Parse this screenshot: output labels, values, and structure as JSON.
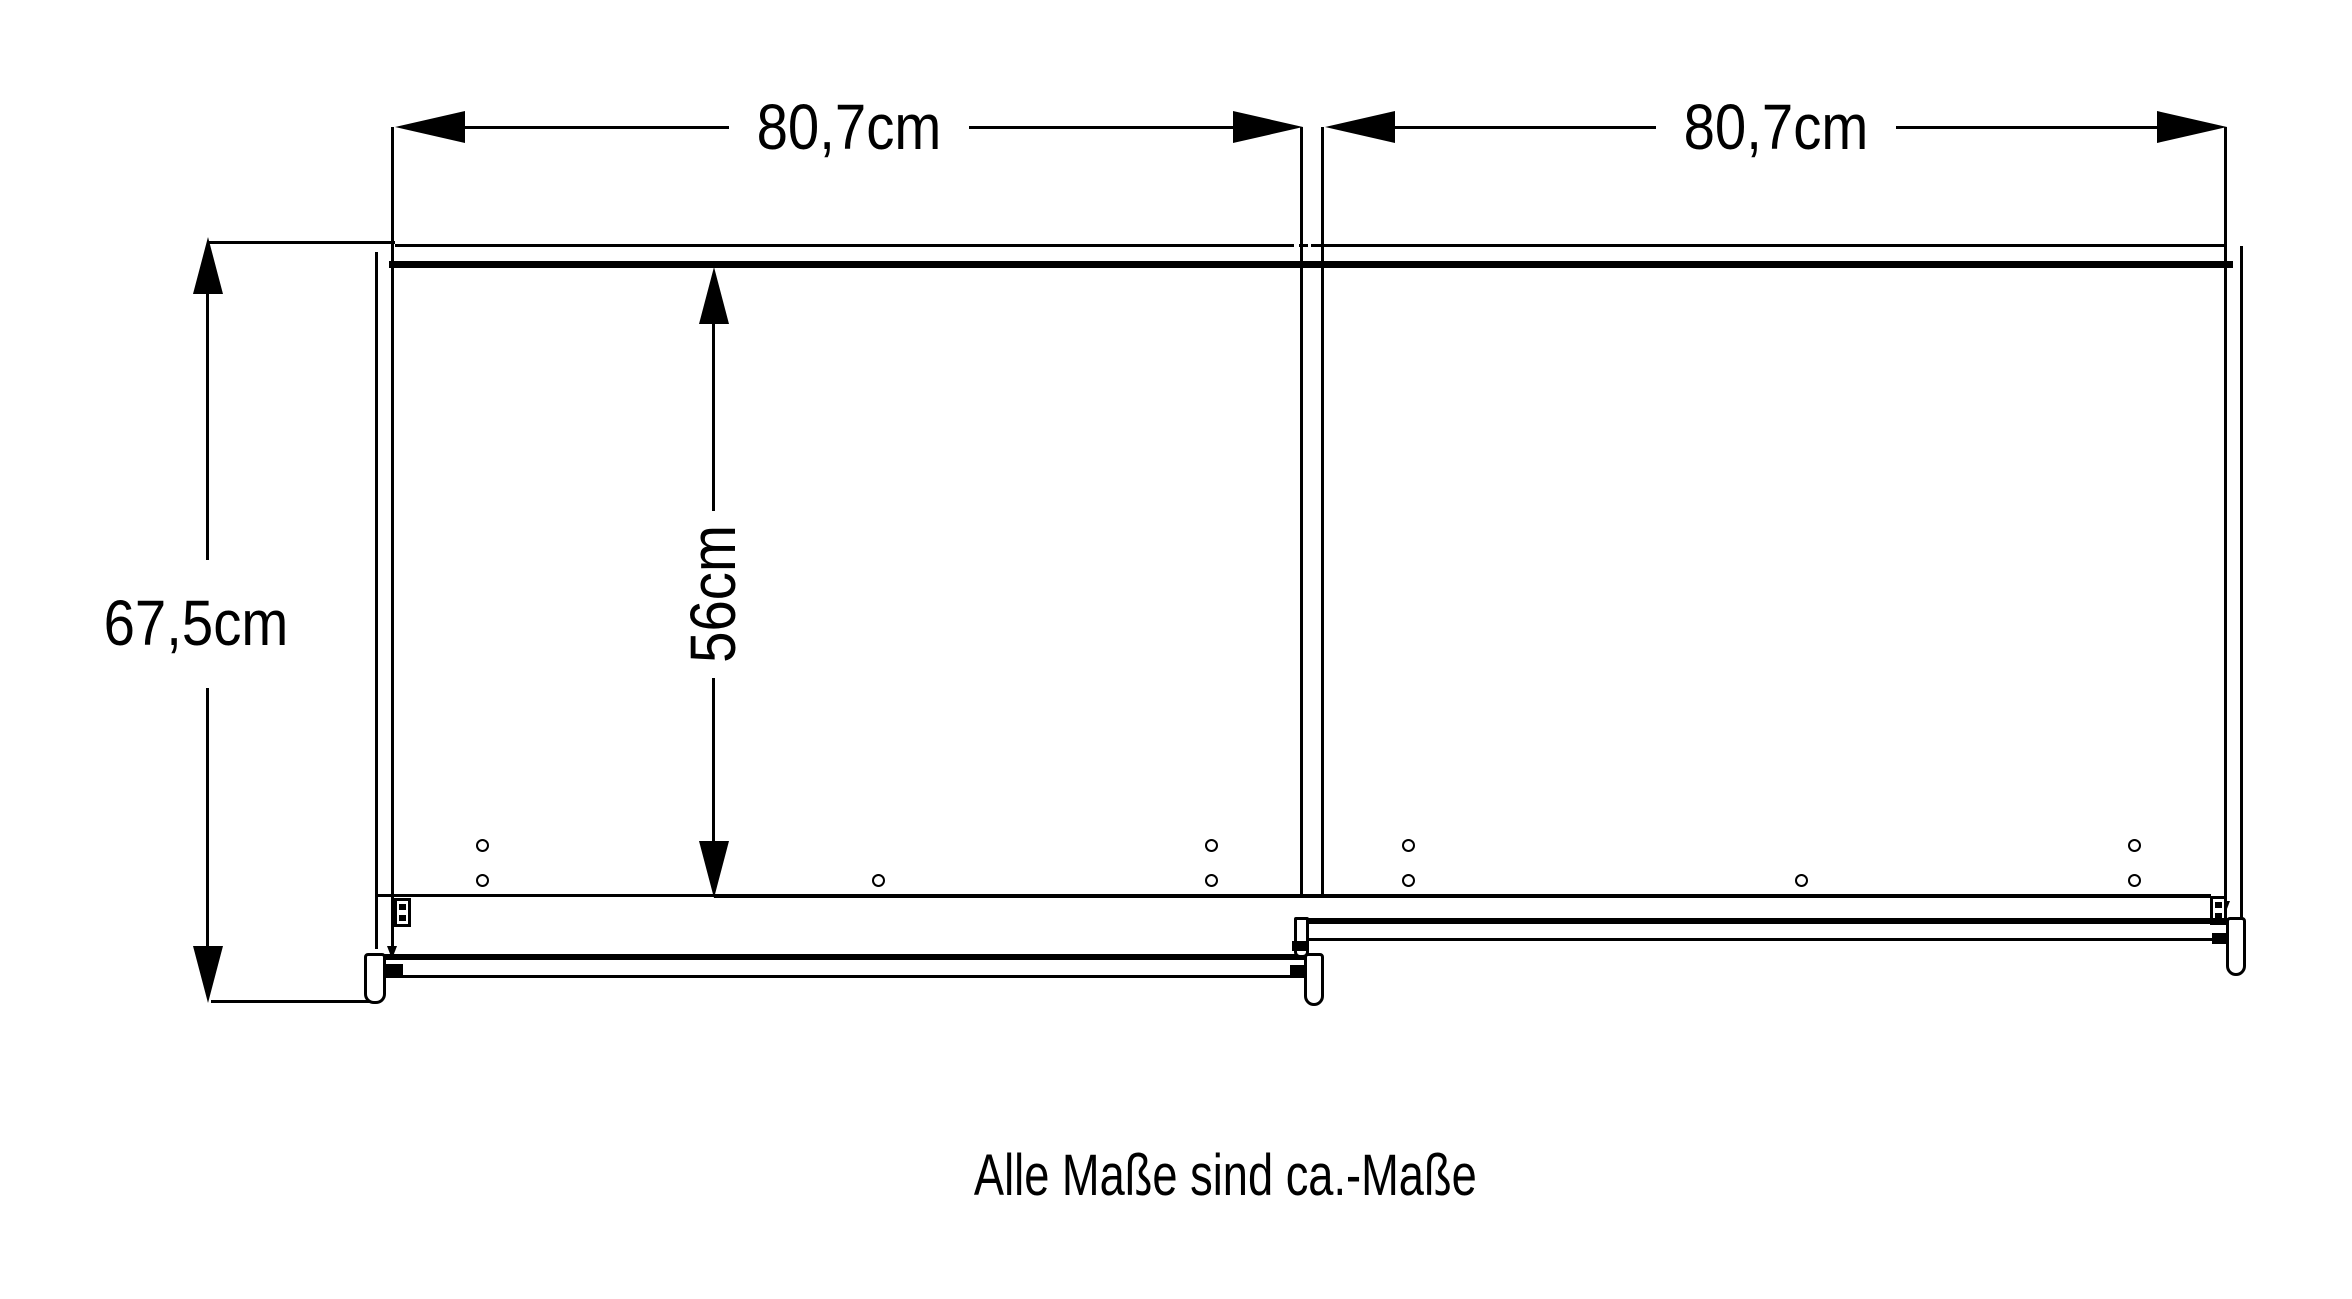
{
  "dimensions": {
    "door_left_width": "80,7cm",
    "door_right_width": "80,7cm",
    "total_depth": "67,5cm",
    "interior_depth": "56cm"
  },
  "caption": "Alle Maße sind ca.-Maße",
  "colors": {
    "line": "#000000",
    "background": "#ffffff"
  }
}
